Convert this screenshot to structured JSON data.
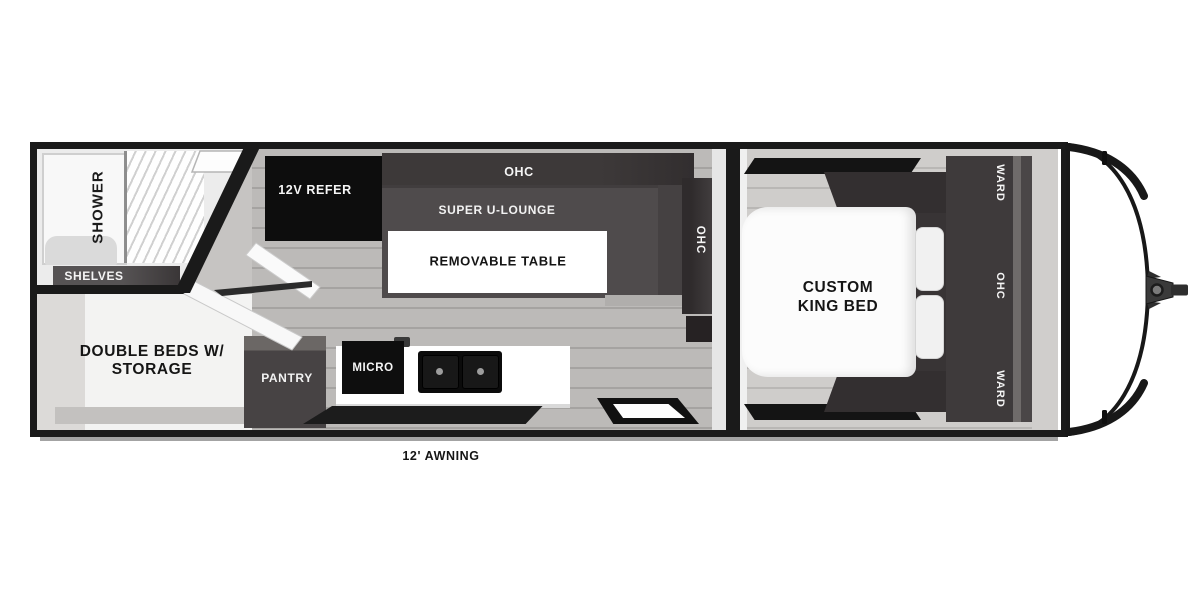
{
  "plan_type": "travel-trailer-floorplan",
  "labels": {
    "shower": "SHOWER",
    "shelves": "SHELVES",
    "double_beds_line1": "DOUBLE BEDS W/",
    "double_beds_line2": "STORAGE",
    "refer": "12V REFER",
    "ohc_galley": "OHC",
    "lounge": "SUPER U-LOUNGE",
    "table": "REMOVABLE TABLE",
    "ohc_dinette": "OHC",
    "pantry": "PANTRY",
    "micro": "MICRO",
    "bed_line1": "CUSTOM",
    "bed_line2": "KING BED",
    "ward_top": "WARD",
    "ohc_bedroom": "OHC",
    "ward_bottom": "WARD",
    "awning": "12' AWNING"
  },
  "colors": {
    "wall": "#1a1a1a",
    "cabinet-dark": "#3b3738",
    "cabinet-black": "#0d0d0d",
    "lounge": "#4f4b4c",
    "floor-living": "#b3b1af",
    "floor-bedroom": "#c9c7c5",
    "white": "#ffffff"
  }
}
